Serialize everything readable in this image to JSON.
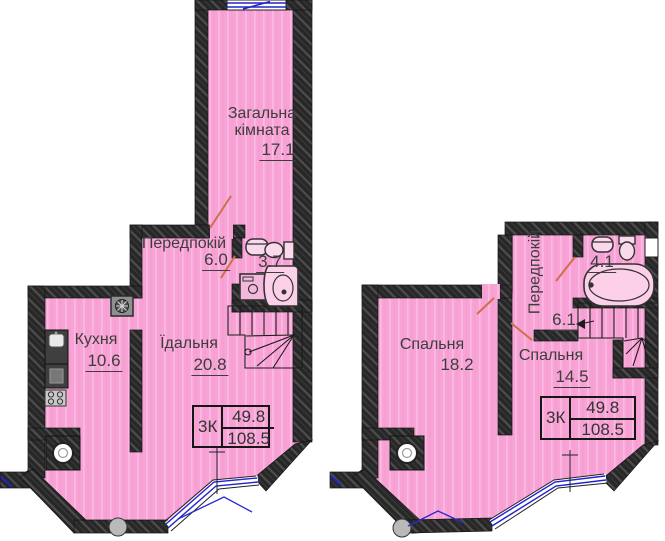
{
  "document": {
    "title": "Duplex apartment floor plan, two levels"
  },
  "colors": {
    "floor_pink": "#f8a3d6",
    "wall_dark": "#2a2a2a",
    "window_blue": "#2323ca",
    "door_orange": "#cf6f4a",
    "text": "#3d3d3d"
  },
  "left": {
    "rooms": {
      "living": {
        "label": "Загальна кімната",
        "area": "17.1"
      },
      "hallway": {
        "label": "Передпокій",
        "area": "6.0"
      },
      "bathroom": {
        "area": "3.7"
      },
      "kitchen": {
        "label": "Кухня",
        "area": "10.6"
      },
      "dining": {
        "label": "Їдальня",
        "area": "20.8"
      }
    },
    "summary": {
      "type": "3К",
      "living_area": "49.8",
      "total_area": "108.5"
    }
  },
  "right": {
    "rooms": {
      "hallway": {
        "label": "Передпокій"
      },
      "bathroom": {
        "area": "4.1"
      },
      "hall": {
        "area": "6.1"
      },
      "bedroom_1": {
        "label": "Спальня",
        "area": "18.2"
      },
      "bedroom_2": {
        "label": "Спальня",
        "area": "14.5"
      }
    },
    "summary": {
      "type": "3К",
      "living_area": "49.8",
      "total_area": "108.5"
    }
  }
}
